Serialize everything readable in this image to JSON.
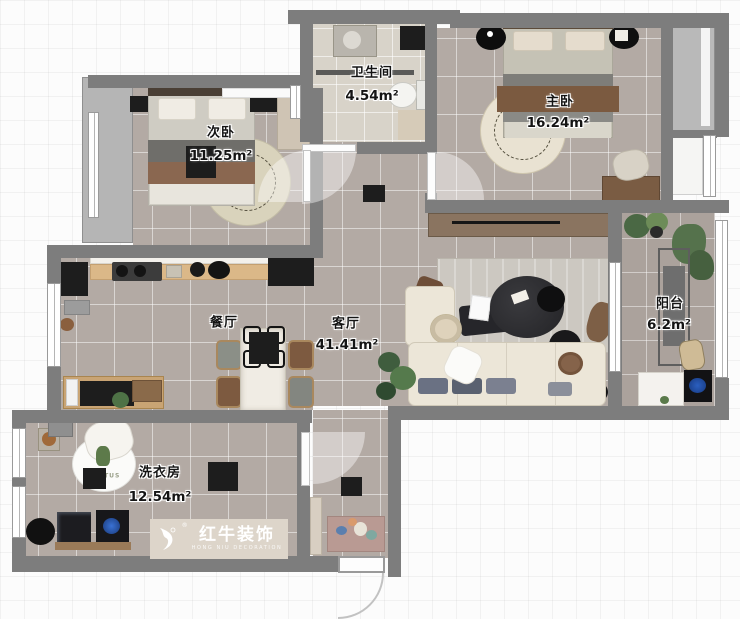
{
  "rooms": [
    {
      "name": "卫生间",
      "area": "4.54m²"
    },
    {
      "name": "主卧",
      "area": "16.24m²"
    },
    {
      "name": "次卧",
      "area": "11.25m²"
    },
    {
      "name": "餐厅",
      "area": ""
    },
    {
      "name": "客厅",
      "area": "41.41m²"
    },
    {
      "name": "阳台",
      "area": "6.2m²"
    },
    {
      "name": "洗衣房",
      "area": "12.54m²"
    }
  ],
  "watermark": {
    "brand": "红牛装饰",
    "subtitle": "HONG NIU DECORATION",
    "registered": "®"
  },
  "decor": {
    "rug_text": "CACTUS"
  },
  "colors": {
    "wall": "#7d7d7d",
    "floor": "#b3aaa4",
    "bath_floor": "#d8d3c9",
    "accent_black": "#1d1d1d",
    "banner": "#ddd5ca"
  }
}
